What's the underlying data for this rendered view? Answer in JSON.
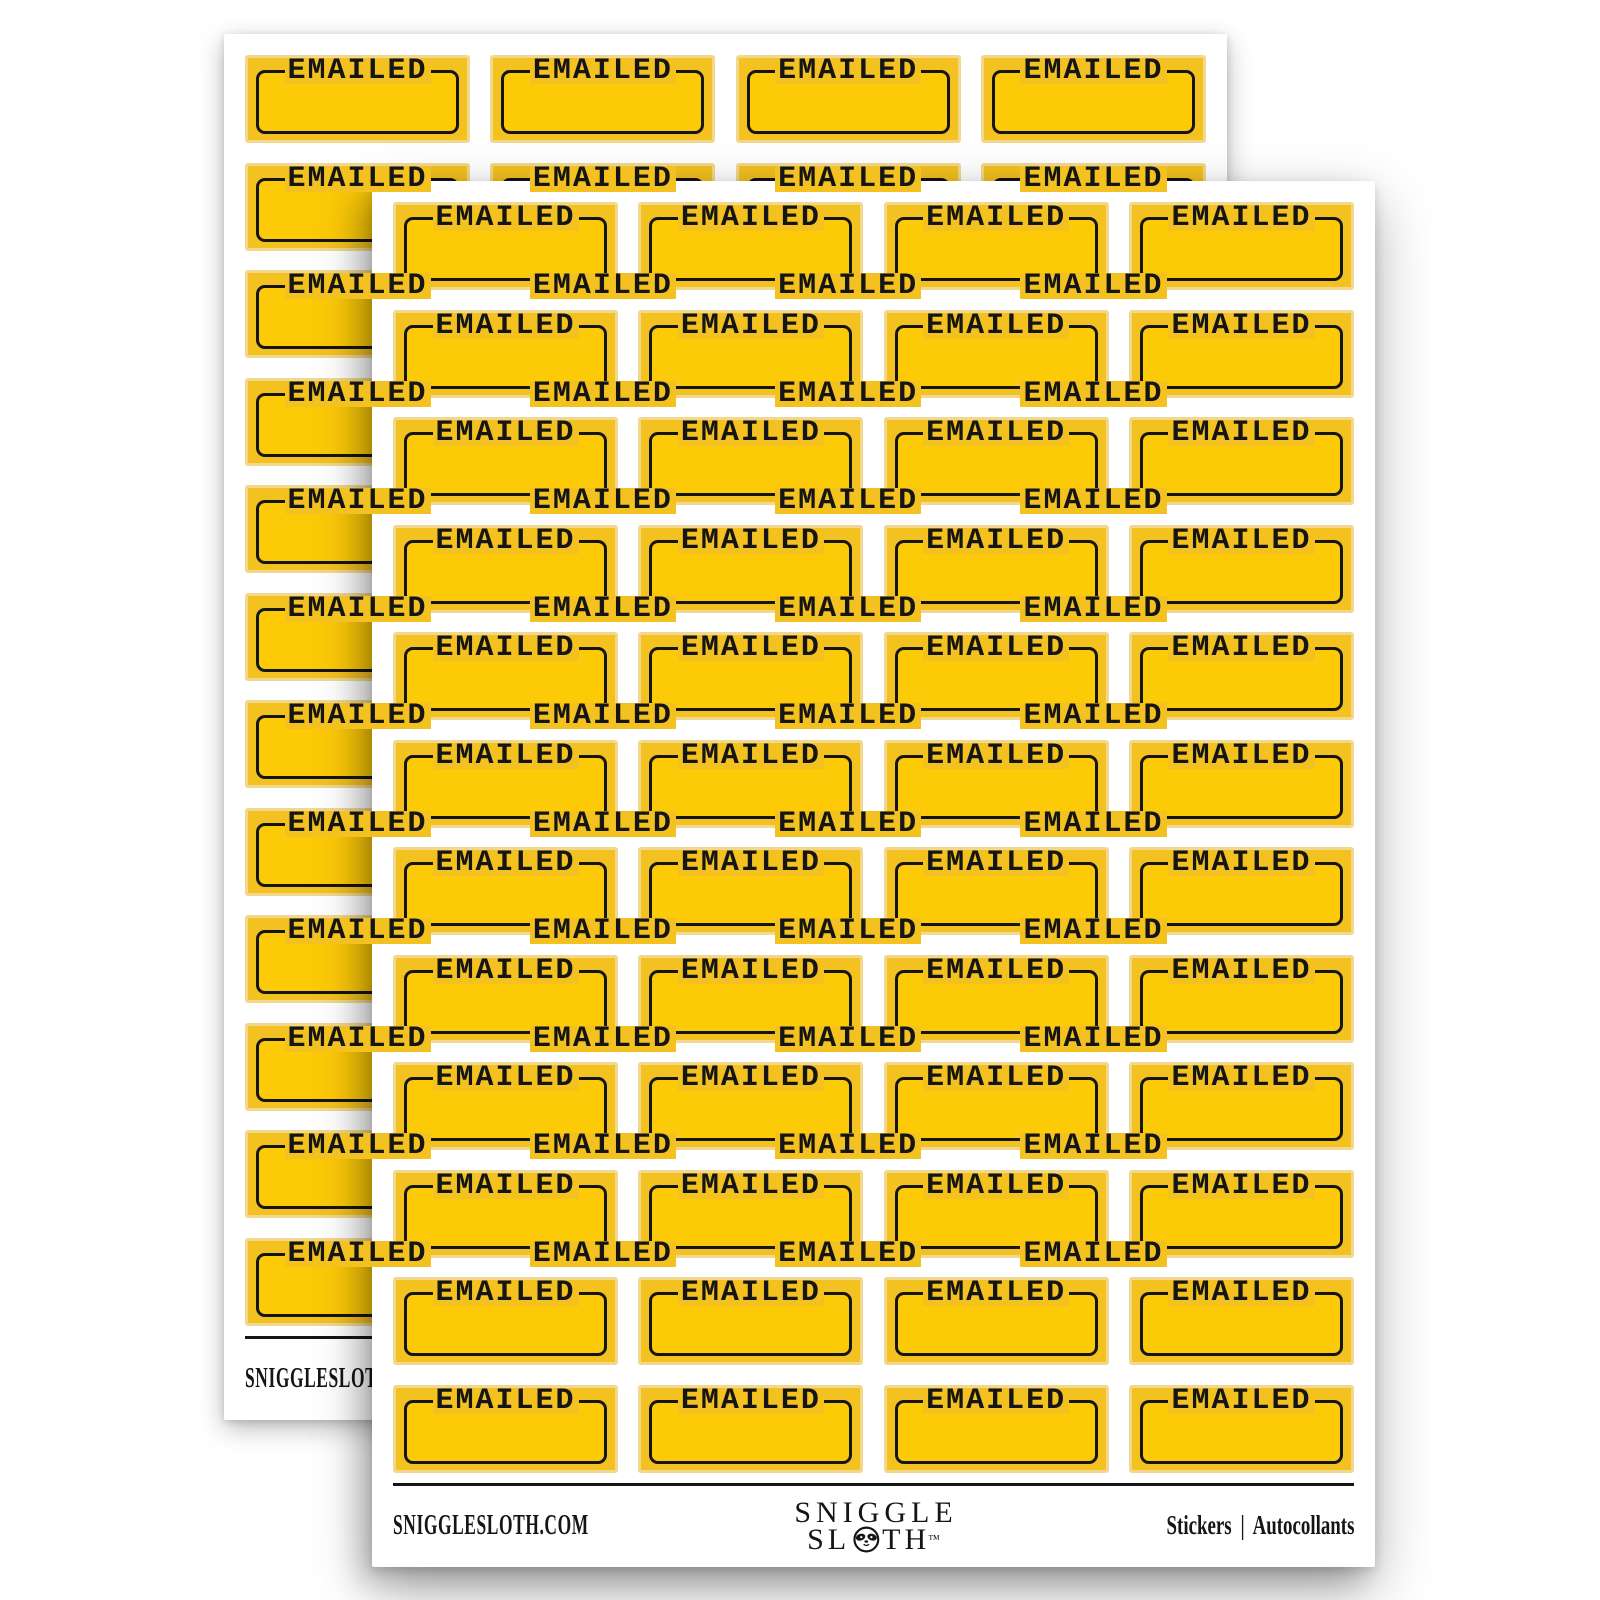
{
  "product": {
    "description_label": "Two overlapping sheets of EMAILED planner stickers",
    "sheet_count": 2
  },
  "colors": {
    "page_bg": "#ffffff",
    "sheet_bg": "#ffffff",
    "sticker_fill": "#f3c120",
    "sticker_inner": "#fdca08",
    "sticker_rim": "#f2d88e",
    "ink": "#151515"
  },
  "sheet": {
    "grid": {
      "rows": 12,
      "cols": 4,
      "label": "EMAILED"
    },
    "footer": {
      "website": "SNIGGLESLOTH.COM",
      "logo_line1": "SNIGGLE",
      "logo_line2_left": "SL",
      "logo_line2_right": "TH",
      "trademark": "™",
      "right_text": "Stickers | Autocollants"
    }
  }
}
